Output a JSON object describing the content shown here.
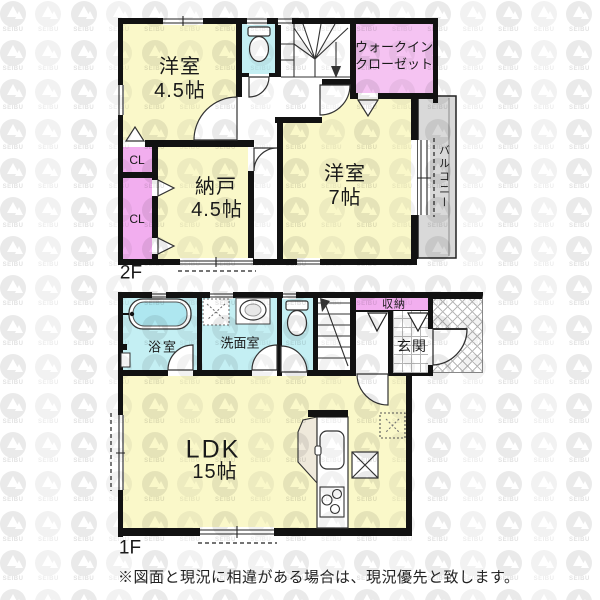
{
  "watermark": {
    "brand": "SEIBU"
  },
  "floor2": {
    "label": "2F",
    "rooms": {
      "western45": {
        "name": "洋室",
        "size": "4.5帖"
      },
      "wic": {
        "line1": "ウォークイン",
        "line2": "クローゼット"
      },
      "western7": {
        "name": "洋室",
        "size": "7帖"
      },
      "nando": {
        "name": "納戸",
        "size": "4.5帖"
      },
      "cl_upper": {
        "label": "CL"
      },
      "cl_lower": {
        "label": "CL"
      },
      "balcony": {
        "label": "バルコニー"
      }
    }
  },
  "floor1": {
    "label": "1F",
    "rooms": {
      "bathroom": {
        "label": "浴室"
      },
      "washroom": {
        "label": "洗面室"
      },
      "storage": {
        "label": "収納"
      },
      "entrance": {
        "label": "玄関"
      },
      "ldk": {
        "name": "LDK",
        "size": "15帖"
      }
    }
  },
  "footnote": "※図面と現況に相違がある場合は、現況優先と致します。",
  "colors": {
    "room_yellow": "#FAF8C9",
    "water_cyan": "#C4EFF3",
    "closet_pink": "#F2AEEF",
    "wic_pink": "#F5C3F2",
    "balcony_gray": "#D9D9D9",
    "tub_cyan": "#AEE7F0",
    "counter_beige": "#EFE9DB",
    "wall_black": "#121212"
  }
}
